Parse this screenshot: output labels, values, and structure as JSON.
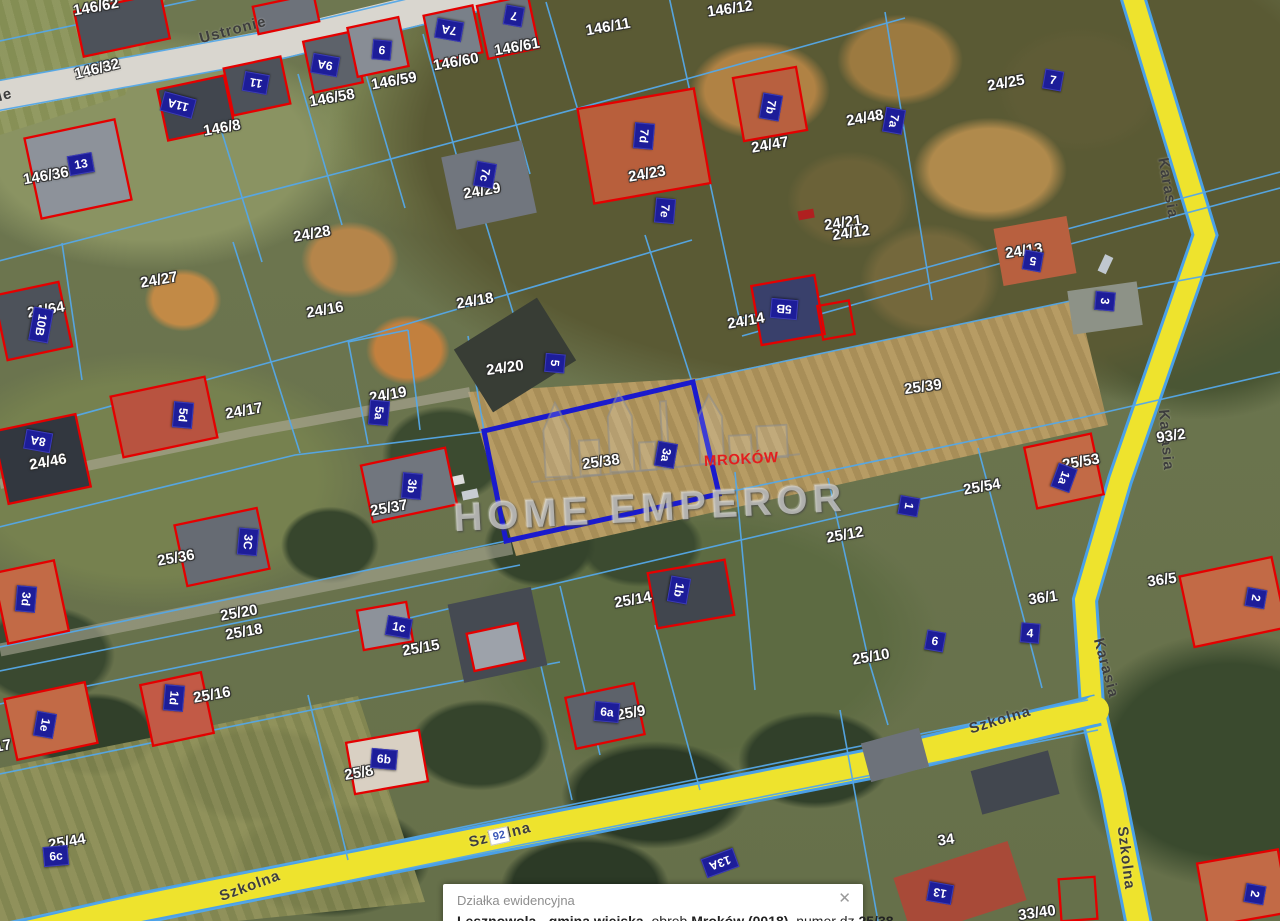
{
  "map": {
    "watermark": {
      "text": "HOME EMPEROR"
    },
    "place_label": "MROKÓW",
    "selected_parcel": "25/38",
    "road_badge": "92",
    "accent_colors": {
      "parcel_line": "#55a8e8",
      "selected_parcel": "#1a1acd",
      "building_outline": "#e40000",
      "road_fill": "#eee32d",
      "plate_bg": "#1d1d99",
      "place_text": "#e31e1e"
    },
    "street_labels": [
      {
        "t": "Ustronie",
        "x": 233,
        "y": 30,
        "r": -15
      },
      {
        "t": "ie",
        "x": 5,
        "y": 95,
        "r": -15
      },
      {
        "t": "Karasia",
        "x": 1168,
        "y": 188,
        "r": 80
      },
      {
        "t": "Karasia",
        "x": 1166,
        "y": 440,
        "r": 85
      },
      {
        "t": "Karasia",
        "x": 1106,
        "y": 668,
        "r": 75
      },
      {
        "t": "Szkolna",
        "x": 1000,
        "y": 720,
        "r": -17
      },
      {
        "t": "Szkolna",
        "x": 500,
        "y": 835,
        "r": -14
      },
      {
        "t": "Szkolna",
        "x": 250,
        "y": 886,
        "r": -20
      },
      {
        "t": "Szkolna",
        "x": 1126,
        "y": 858,
        "r": 83
      }
    ],
    "parcel_labels": [
      {
        "t": "146/62",
        "x": 96,
        "y": 7,
        "r": -10
      },
      {
        "t": "146/11",
        "x": 608,
        "y": 27,
        "r": -10
      },
      {
        "t": "146/12",
        "x": 730,
        "y": 9,
        "r": -8
      },
      {
        "t": "146/32",
        "x": 97,
        "y": 69,
        "r": -14
      },
      {
        "t": "146/8",
        "x": 222,
        "y": 128,
        "r": -10
      },
      {
        "t": "146/58",
        "x": 332,
        "y": 98,
        "r": -10
      },
      {
        "t": "146/59",
        "x": 394,
        "y": 81,
        "r": -10
      },
      {
        "t": "146/60",
        "x": 456,
        "y": 62,
        "r": -10
      },
      {
        "t": "146/61",
        "x": 517,
        "y": 47,
        "r": -10
      },
      {
        "t": "146/36",
        "x": 46,
        "y": 176,
        "r": -10
      },
      {
        "t": "24/25",
        "x": 1006,
        "y": 83,
        "r": -10
      },
      {
        "t": "24/48",
        "x": 865,
        "y": 118,
        "r": -10
      },
      {
        "t": "24/47",
        "x": 770,
        "y": 145,
        "r": -10
      },
      {
        "t": "24/23",
        "x": 647,
        "y": 174,
        "r": -10
      },
      {
        "t": "24/29",
        "x": 482,
        "y": 191,
        "r": -10
      },
      {
        "t": "24/28",
        "x": 312,
        "y": 234,
        "r": -10
      },
      {
        "t": "24/27",
        "x": 159,
        "y": 280,
        "r": -10
      },
      {
        "t": "24/21",
        "x": 843,
        "y": 223,
        "r": -8
      },
      {
        "t": "24/12",
        "x": 851,
        "y": 233,
        "r": -8
      },
      {
        "t": "24/13",
        "x": 1024,
        "y": 251,
        "r": -8
      },
      {
        "t": "24/64",
        "x": 46,
        "y": 310,
        "r": -10
      },
      {
        "t": "24/16",
        "x": 325,
        "y": 310,
        "r": -10
      },
      {
        "t": "24/18",
        "x": 475,
        "y": 301,
        "r": -10
      },
      {
        "t": "24/20",
        "x": 505,
        "y": 368,
        "r": -8
      },
      {
        "t": "24/19",
        "x": 388,
        "y": 395,
        "r": -10
      },
      {
        "t": "24/17",
        "x": 244,
        "y": 411,
        "r": -10
      },
      {
        "t": "24/46",
        "x": 48,
        "y": 462,
        "r": -10
      },
      {
        "t": "24/14",
        "x": 746,
        "y": 321,
        "r": -10
      },
      {
        "t": "25/39",
        "x": 923,
        "y": 387,
        "r": -8
      },
      {
        "t": "93/2",
        "x": 1171,
        "y": 436,
        "r": -8
      },
      {
        "t": "25/53",
        "x": 1081,
        "y": 462,
        "r": -10
      },
      {
        "t": "25/54",
        "x": 982,
        "y": 487,
        "r": -10
      },
      {
        "t": "25/38",
        "x": 601,
        "y": 462,
        "r": -8
      },
      {
        "t": "25/37",
        "x": 389,
        "y": 508,
        "r": -10
      },
      {
        "t": "25/36",
        "x": 176,
        "y": 558,
        "r": -10
      },
      {
        "t": "25/12",
        "x": 845,
        "y": 535,
        "r": -10
      },
      {
        "t": "25/14",
        "x": 633,
        "y": 600,
        "r": -10
      },
      {
        "t": "25/20",
        "x": 239,
        "y": 613,
        "r": -10
      },
      {
        "t": "25/18",
        "x": 244,
        "y": 632,
        "r": -10
      },
      {
        "t": "25/15",
        "x": 421,
        "y": 648,
        "r": -10
      },
      {
        "t": "25/16",
        "x": 212,
        "y": 695,
        "r": -10
      },
      {
        "t": "25/10",
        "x": 871,
        "y": 657,
        "r": -10
      },
      {
        "t": "36/1",
        "x": 1043,
        "y": 598,
        "r": -8
      },
      {
        "t": "36/5",
        "x": 1162,
        "y": 580,
        "r": -8
      },
      {
        "t": "25/9",
        "x": 631,
        "y": 713,
        "r": -10
      },
      {
        "t": "25/8",
        "x": 359,
        "y": 773,
        "r": -10
      },
      {
        "t": "25/44",
        "x": 67,
        "y": 842,
        "r": -10
      },
      {
        "t": "34",
        "x": 946,
        "y": 840,
        "r": -8
      },
      {
        "t": "33/40",
        "x": 1037,
        "y": 913,
        "r": -8
      },
      {
        "t": "17",
        "x": 3,
        "y": 746,
        "r": -10
      }
    ],
    "building_plates": [
      {
        "t": "13",
        "x": 81,
        "y": 164,
        "r": -10
      },
      {
        "t": "11A",
        "x": 178,
        "y": 105,
        "r": 195
      },
      {
        "t": "11",
        "x": 256,
        "y": 83,
        "r": 190
      },
      {
        "t": "9A",
        "x": 325,
        "y": 65,
        "r": 190
      },
      {
        "t": "9",
        "x": 382,
        "y": 50,
        "r": 185
      },
      {
        "t": "7A",
        "x": 449,
        "y": 30,
        "r": 190
      },
      {
        "t": "7",
        "x": 514,
        "y": 16,
        "r": 190
      },
      {
        "t": "7c",
        "x": 485,
        "y": 175,
        "r": 100
      },
      {
        "t": "7d",
        "x": 644,
        "y": 136,
        "r": 95
      },
      {
        "t": "7e",
        "x": 665,
        "y": 211,
        "r": 95
      },
      {
        "t": "7b",
        "x": 771,
        "y": 107,
        "r": 100
      },
      {
        "t": "7a",
        "x": 894,
        "y": 121,
        "r": 100
      },
      {
        "t": "7",
        "x": 1053,
        "y": 80,
        "r": 10
      },
      {
        "t": "5",
        "x": 1033,
        "y": 261,
        "r": 190
      },
      {
        "t": "3",
        "x": 1105,
        "y": 301,
        "r": 95
      },
      {
        "t": "5B",
        "x": 784,
        "y": 309,
        "r": 185
      },
      {
        "t": "10B",
        "x": 41,
        "y": 325,
        "r": 100
      },
      {
        "t": "5d",
        "x": 183,
        "y": 415,
        "r": 95
      },
      {
        "t": "8A",
        "x": 38,
        "y": 441,
        "r": 190
      },
      {
        "t": "5",
        "x": 555,
        "y": 363,
        "r": 95
      },
      {
        "t": "5a",
        "x": 379,
        "y": 413,
        "r": 95
      },
      {
        "t": "3b",
        "x": 412,
        "y": 486,
        "r": 95
      },
      {
        "t": "3a",
        "x": 666,
        "y": 455,
        "r": 100
      },
      {
        "t": "1a",
        "x": 1064,
        "y": 478,
        "r": 110
      },
      {
        "t": "1",
        "x": 909,
        "y": 506,
        "r": 100
      },
      {
        "t": "2",
        "x": 1256,
        "y": 598,
        "r": 100
      },
      {
        "t": "4",
        "x": 1030,
        "y": 633,
        "r": 5
      },
      {
        "t": "6",
        "x": 935,
        "y": 641,
        "r": 10
      },
      {
        "t": "1b",
        "x": 679,
        "y": 590,
        "r": 100
      },
      {
        "t": "3C",
        "x": 248,
        "y": 542,
        "r": 95
      },
      {
        "t": "3d",
        "x": 26,
        "y": 599,
        "r": 95
      },
      {
        "t": "1c",
        "x": 399,
        "y": 627,
        "r": 10
      },
      {
        "t": "1d",
        "x": 174,
        "y": 698,
        "r": 95
      },
      {
        "t": "1e",
        "x": 45,
        "y": 725,
        "r": 100
      },
      {
        "t": "6c",
        "x": 56,
        "y": 856,
        "r": -5
      },
      {
        "t": "6b",
        "x": 384,
        "y": 759,
        "r": 5
      },
      {
        "t": "6a",
        "x": 607,
        "y": 712,
        "r": 5
      },
      {
        "t": "13A",
        "x": 720,
        "y": 863,
        "r": 160
      },
      {
        "t": "13",
        "x": 940,
        "y": 893,
        "r": 190
      },
      {
        "t": "2",
        "x": 1255,
        "y": 894,
        "r": 100
      }
    ]
  },
  "popup": {
    "title": "Działka ewidencyjna",
    "close": "✕",
    "segments": [
      {
        "text": "Lesznowola - gmina wiejska",
        "cls": "b"
      },
      {
        "text": ", obręb "
      },
      {
        "text": "Mroków (0018)",
        "cls": "b"
      },
      {
        "text": ", numer dz."
      },
      {
        "text": "25/38",
        "cls": "b"
      }
    ]
  }
}
